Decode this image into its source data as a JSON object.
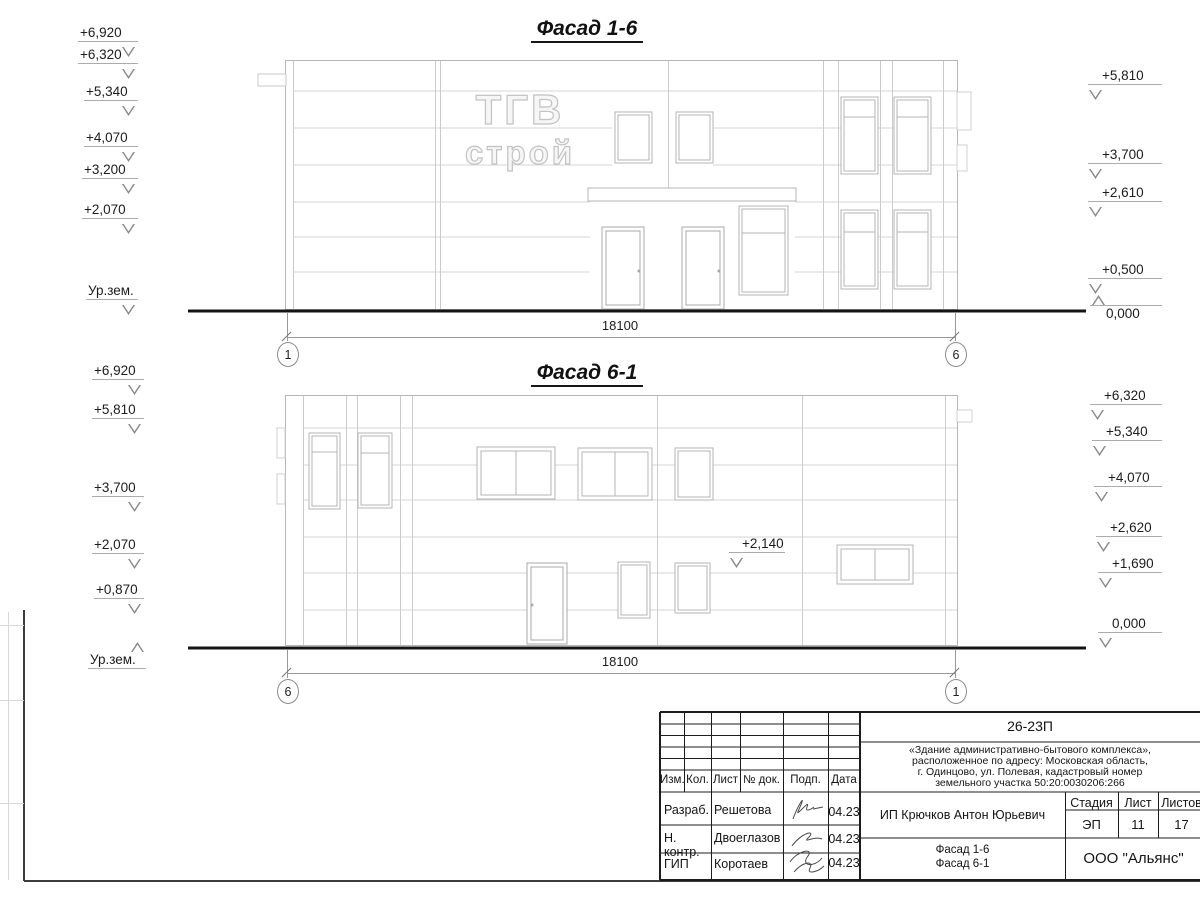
{
  "facade1": {
    "title": "Фасад 1-6",
    "dimension": "18100",
    "axis_left": "1",
    "axis_right": "6",
    "left_marks": [
      "+6,920",
      "+6,320",
      "+5,340",
      "+4,070",
      "+3,200",
      "+2,070",
      "Ур.зем."
    ],
    "right_marks": [
      "+5,810",
      "+3,700",
      "+2,610",
      "+0,500",
      "0,000"
    ]
  },
  "facade2": {
    "title": "Фасад 6-1",
    "dimension": "18100",
    "axis_left": "6",
    "axis_right": "1",
    "left_marks": [
      "+6,920",
      "+5,810",
      "+3,700",
      "+2,070",
      "+0,870",
      "Ур.зем."
    ],
    "right_marks": [
      "+6,320",
      "+5,340",
      "+4,070",
      "+2,620",
      "+1,690",
      "0,000"
    ],
    "facade_mark": "+2,140"
  },
  "logo": {
    "line1": "ТГВ",
    "line2": "строй"
  },
  "titleblock": {
    "doc_number": "26-23П",
    "description_lines": [
      "«Здание административно-бытового комплекса»,",
      "расположенное по адресу: Московская область,",
      "г. Одинцово, ул. Полевая, кадастровый номер",
      "земельного участка 50:20:0030206:266"
    ],
    "client": "ИП Крючков Антон Юрьевич",
    "stage_label": "Стадия",
    "sheet_label": "Лист",
    "sheets_label": "Листов",
    "stage_value": "ЭП",
    "sheet_value": "11",
    "sheets_value": "17",
    "sheet_titles": [
      "Фасад 1-6",
      "Фасад 6-1"
    ],
    "company": "ООО \"Альянс\"",
    "header_cols": [
      "Изм.",
      "Кол.",
      "Лист",
      "№ док.",
      "Подп.",
      "Дата"
    ],
    "rows": [
      {
        "role": "Разраб.",
        "name": "Решетова",
        "date": "04.23"
      },
      {
        "role": "Н. контр.",
        "name": "Двоеглазов",
        "date": "04.23"
      },
      {
        "role": "ГИП",
        "name": "Коротаев",
        "date": "04.23"
      }
    ]
  }
}
